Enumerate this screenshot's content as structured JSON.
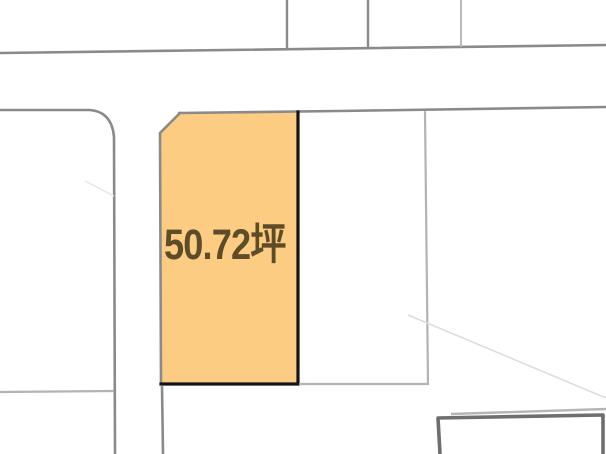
{
  "map": {
    "background_color": "#FFFFFF",
    "road_line_color": "#8A8A8A",
    "parcel_line_color": "#B3B3B3",
    "faint_line_color": "#D8DDE2",
    "faint_line_color_left": "#E2E6EA",
    "building_roof_line_color": "#B5B5B5",
    "building_outline_color": "#6E6E6E"
  },
  "plot": {
    "area_label": "50.72坪",
    "fill_color": "#FBCC81",
    "highlight_border_color": "#141414",
    "boundary_line_color": "#8A8A8A",
    "label_color": "#5E4C28"
  }
}
